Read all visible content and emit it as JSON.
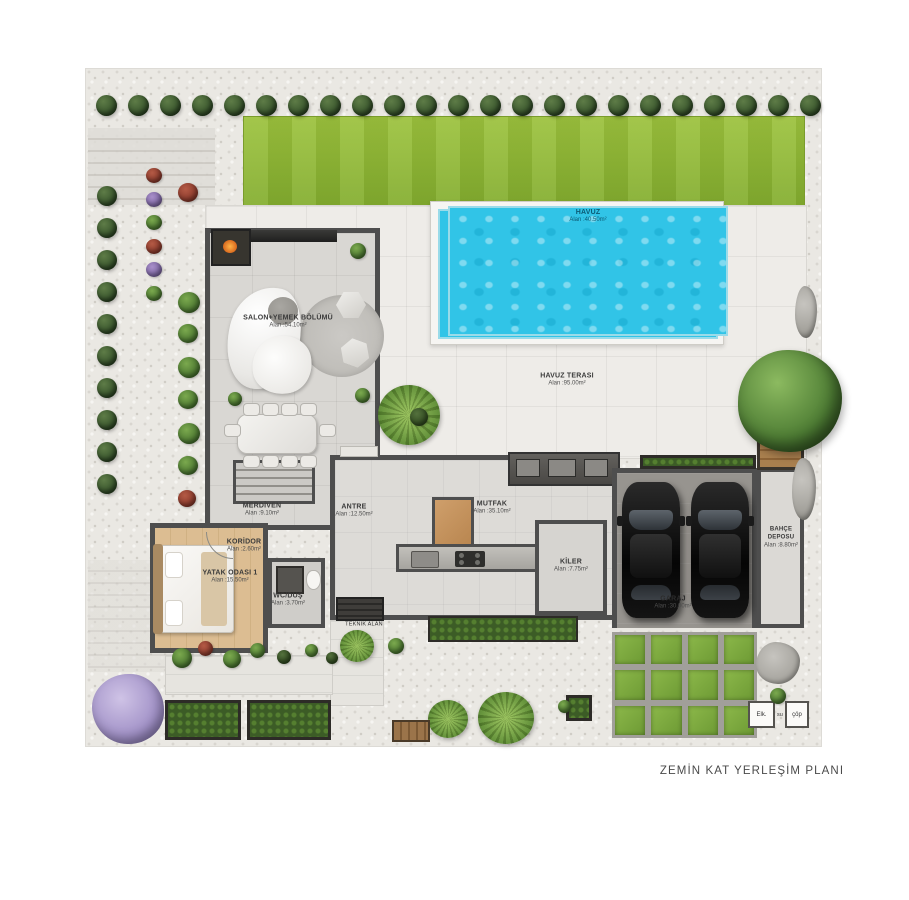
{
  "plan": {
    "title": "ZEMİN KAT YERLEŞİM PLANI",
    "rooms": {
      "havuz": {
        "name": "HAVUZ",
        "area": "Alan :40.50m²"
      },
      "havuz_terasi": {
        "name": "HAVUZ TERASI",
        "area": "Alan :95.00m²"
      },
      "salon": {
        "name": "SALON+YEMEK BÖLÜMÜ",
        "area": "Alan :54.10m²"
      },
      "merdiven": {
        "name": "MERDİVEN",
        "area": "Alan :9.10m²"
      },
      "antre": {
        "name": "ANTRE",
        "area": "Alan :12.50m²"
      },
      "mutfak": {
        "name": "MUTFAK",
        "area": "Alan :35.10m²"
      },
      "kiler": {
        "name": "KİLER",
        "area": "Alan :7.75m²"
      },
      "koridor": {
        "name": "KORİDOR",
        "area": "Alan :2.60m²"
      },
      "yatak_odasi": {
        "name": "YATAK ODASI 1",
        "area": "Alan :15.50m²"
      },
      "wc_dus": {
        "name": "WC/DUŞ",
        "area": "Alan :3.70m²"
      },
      "garaj": {
        "name": "GARAJ",
        "area": "Alan :30.00m²"
      },
      "bahce_deposu": {
        "name": "BAHÇE DEPOSU",
        "area": "Alan :8.80m²"
      },
      "teknik": {
        "name": "TEKNİK ALAN"
      }
    },
    "utilities": {
      "elk": "Elk.",
      "su": "su",
      "cop": "çöp"
    },
    "colors": {
      "pool_water": "#31c4e7",
      "lawn": "#8cb53a",
      "gravel": "#eae8e3",
      "wall": "#4e4e4e",
      "garage_floor": "#97948f",
      "grass_paver": "#7fae3f",
      "wood": "#c89a66"
    }
  }
}
